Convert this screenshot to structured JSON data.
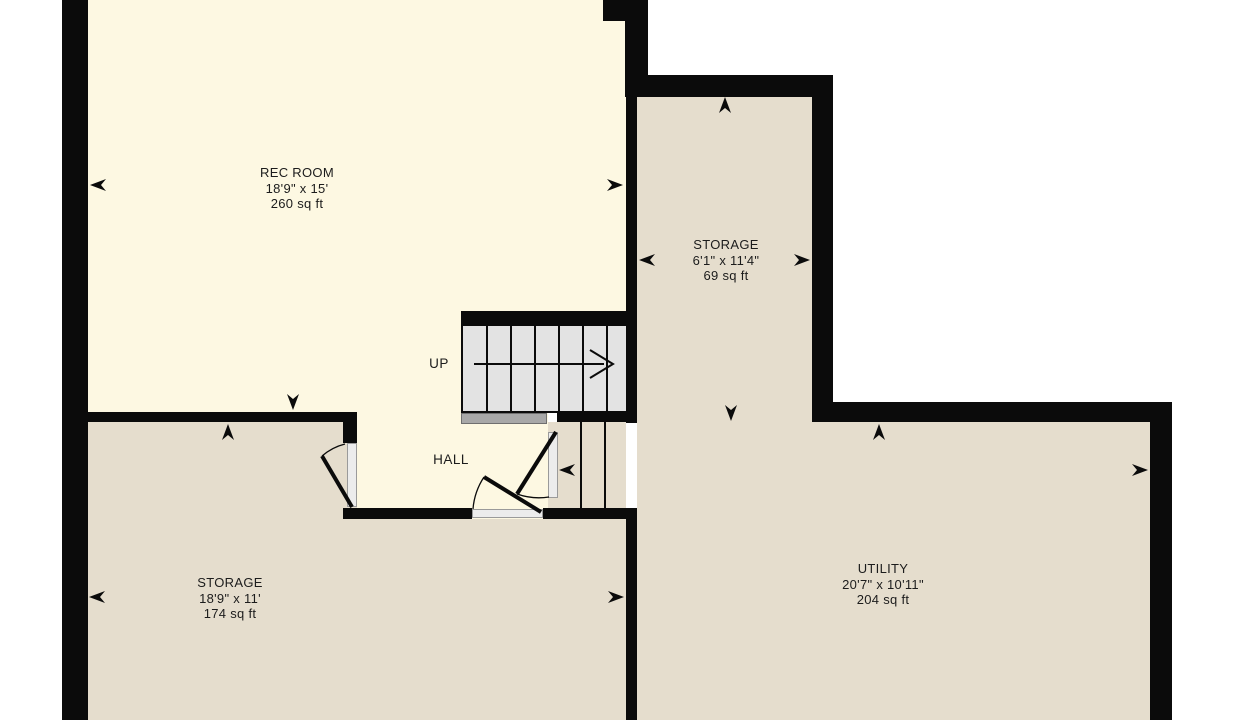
{
  "colors": {
    "background": "#ffffff",
    "wall": "#0b0b0b",
    "room_cream": "#fdf8e2",
    "room_beige": "#e5ddcd",
    "stair_fill": "#e3e3e3",
    "landing_fill": "#a8a8a8",
    "door_jamb": "#ececec",
    "text": "#1c1c1c"
  },
  "rooms": [
    {
      "id": "rec-room",
      "name": "REC ROOM",
      "dimensions": "18'9\" x 15'",
      "area": "260 sq ft"
    },
    {
      "id": "storage-upper",
      "name": "STORAGE",
      "dimensions": "6'1\" x 11'4\"",
      "area": "69 sq ft"
    },
    {
      "id": "storage-lower",
      "name": "STORAGE",
      "dimensions": "18'9\" x 11'",
      "area": "174 sq ft"
    },
    {
      "id": "utility",
      "name": "UTILITY",
      "dimensions": "20'7\" x 10'11\"",
      "area": "204 sq ft"
    }
  ],
  "labels": {
    "stairs_direction": "UP",
    "hall": "HALL"
  },
  "icons": {
    "measure-arrow-icon": "black dart arrowhead marking a wall measurement point",
    "stairs-direction-icon": "line with open chevron showing stair run direction",
    "door-swing-arc": "quarter-circle arc showing door swing",
    "door-leaf": "thick diagonal line showing open door panel"
  }
}
